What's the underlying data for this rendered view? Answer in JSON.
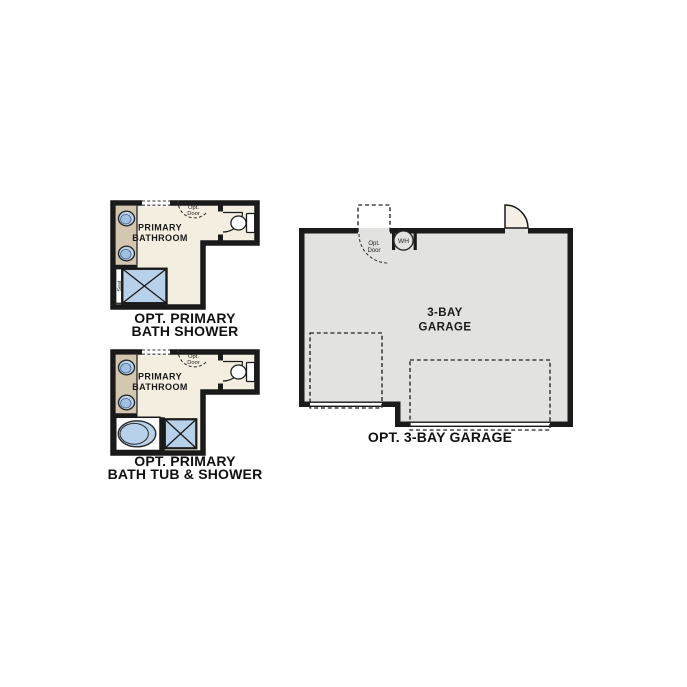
{
  "colors": {
    "background": "#ffffff",
    "wall": "#1a1a1a",
    "bathroom_floor": "#f4eee1",
    "vanity": "#d3c7af",
    "fixture_blue": "#b7d1ea",
    "fixture_blue_dark": "#9fc0e0",
    "sink_rim": "#bdd4ea",
    "garage_floor": "#e2e2e0",
    "door_fill": "#f5efe6"
  },
  "plans": {
    "bath_shower": {
      "room_label_line1": "PRIMARY",
      "room_label_line2": "BATHROOM",
      "opt_door_line1": "Opt.",
      "opt_door_line2": "Door",
      "seat_label": "Seat",
      "caption_line1": "OPT. PRIMARY",
      "caption_line2": "BATH SHOWER"
    },
    "bath_tub_shower": {
      "room_label_line1": "PRIMARY",
      "room_label_line2": "BATHROOM",
      "opt_door_line1": "Opt.",
      "opt_door_line2": "Door",
      "caption_line1": "OPT. PRIMARY",
      "caption_line2": "BATH TUB & SHOWER"
    },
    "garage": {
      "room_label_line1": "3-BAY",
      "room_label_line2": "GARAGE",
      "opt_door_line1": "Opt.",
      "opt_door_line2": "Door",
      "water_heater_label": "WH",
      "caption": "OPT. 3-BAY GARAGE"
    }
  }
}
